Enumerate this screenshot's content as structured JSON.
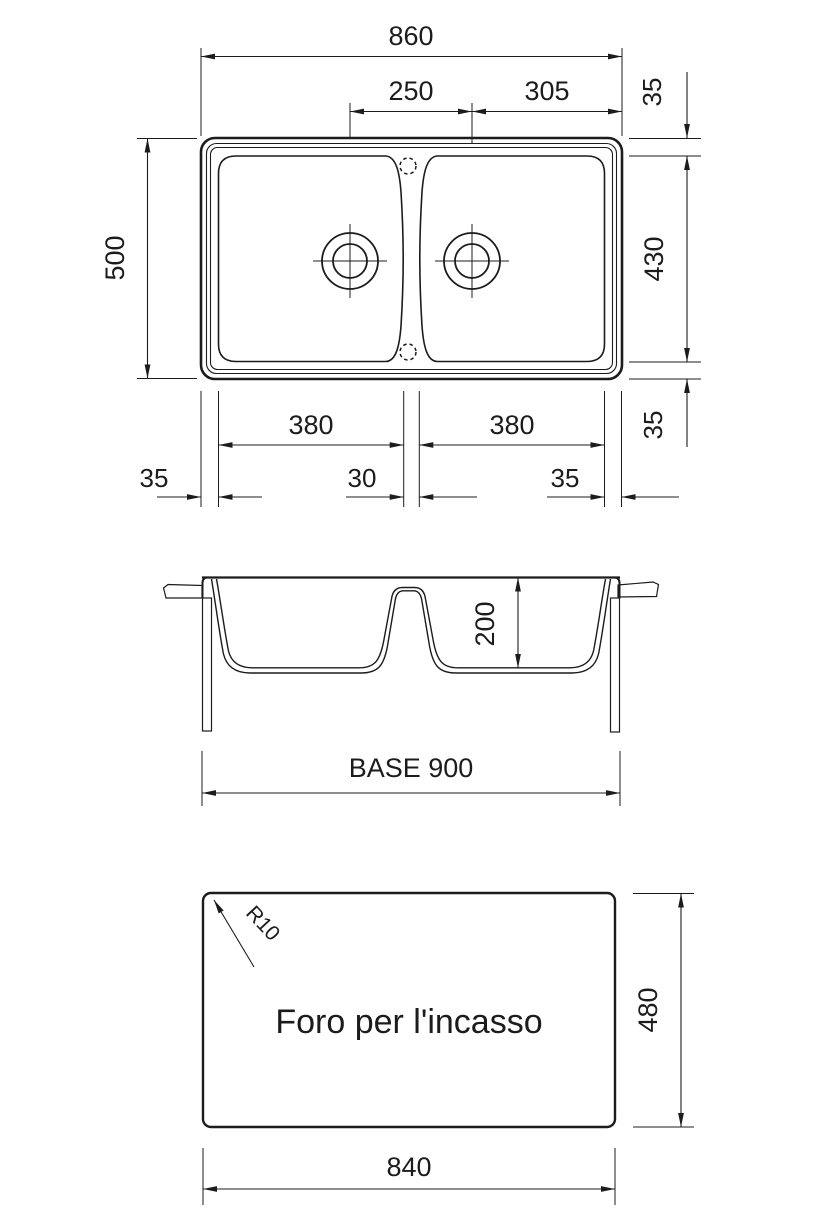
{
  "document": {
    "type": "technical-drawing",
    "subject": "double-bowl inset sink dimensional drawing",
    "views": [
      "plan-top-view",
      "cross-section-view",
      "worktop-cutout-view"
    ]
  },
  "colors": {
    "line": "#1c1c1c",
    "background": "#ffffff"
  },
  "labels": {
    "dim_overall_width": "860",
    "dim_drain_spacing": "250",
    "dim_drain_to_edge": "305",
    "dim_rim_top": "35",
    "dim_bowl_depth_plan": "430",
    "dim_rim_bottom": "35",
    "dim_overall_depth": "500",
    "dim_bowl_width_left": "380",
    "dim_bowl_width_right": "380",
    "dim_rim_left": "35",
    "dim_divider": "30",
    "dim_rim_right": "35",
    "dim_bowl_depth_section": "200",
    "dim_base": "BASE 900",
    "dim_corner_radius": "R10",
    "cutout_label": "Foro per l'incasso",
    "dim_cutout_height": "480",
    "dim_cutout_width": "840"
  }
}
